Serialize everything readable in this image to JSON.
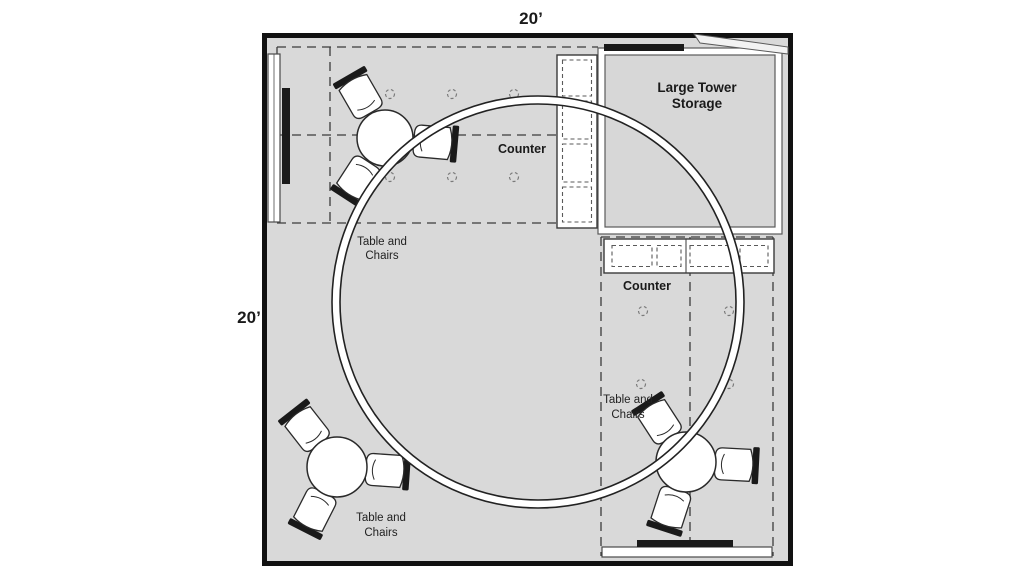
{
  "diagram": {
    "type": "booth-floor-plan",
    "width_label": "20’",
    "height_label": "20’"
  },
  "storage": {
    "line1": "Large Tower",
    "line2": "Storage"
  },
  "counters": {
    "vertical_label": "Counter",
    "horizontal_label": "Counter"
  },
  "table_set": {
    "line1": "Table and",
    "line2": "Chairs"
  },
  "colors": {
    "floor": "#d9d9d9",
    "storage_floor": "#d7d7d7",
    "wall": "#111111",
    "counter_fill": "#ffffff",
    "fixture_bar": "#1a1a1a",
    "dash_line": "#3c3c3c",
    "ring_outline": "#222222"
  }
}
